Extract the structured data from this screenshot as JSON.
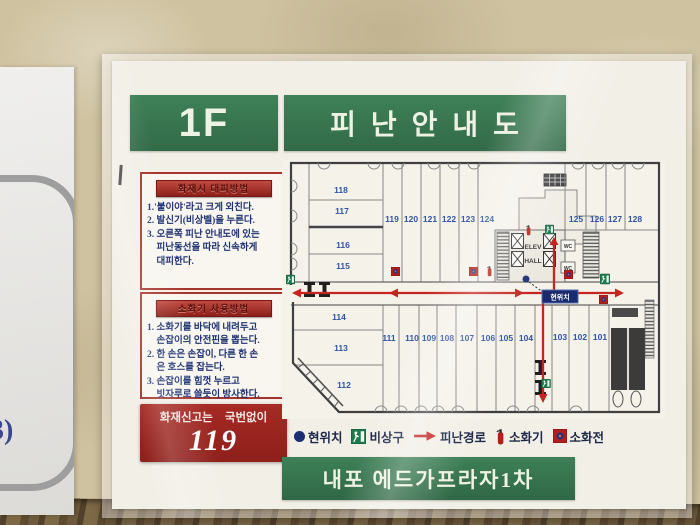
{
  "photo": {
    "side_label": "3)"
  },
  "colors": {
    "header_green": "#37784f",
    "footer_green": "#37784f",
    "alert_red": "#9c241f",
    "route_red": "#c5241f",
    "room_number_blue": "#2e54a3",
    "location_navy": "#1a2a6e",
    "exit_green": "#1e7a4c"
  },
  "sign": {
    "header": {
      "floor": "1F",
      "title": "피난안내도"
    },
    "instructions_fire": {
      "title": "화재시 대피방법",
      "body": "1.'불이야'라고 크게 외친다.\n2. 발신기(비상벨)을 누른다.\n3. 오른쪽 피난 안내도에 있는\n　피난동선을 따라 신속하게\n　대피한다."
    },
    "instructions_extinguisher": {
      "title": "소화기 사용방법",
      "body": "1. 소화기를 바닥에 내려두고\n　손잡이의 안전핀을 뽑는다.\n2. 한 손은 손잡이, 다른 한 손\n　은 호스를 잡는다.\n3. 손잡이를 힘껏 누르고\n　빗자루로 쓸듯이 방사한다."
    },
    "emergency_call": {
      "label": "화재신고는 국번없이",
      "number": "119"
    },
    "legend": {
      "items": [
        {
          "icon": "location-dot",
          "label": "현위치"
        },
        {
          "icon": "emergency-exit",
          "label": "비상구"
        },
        {
          "icon": "route-arrow",
          "label": "피난경로"
        },
        {
          "icon": "fire-extinguisher",
          "label": "소화기"
        },
        {
          "icon": "fire-hydrant",
          "label": "소화전"
        }
      ]
    },
    "footer": {
      "building": "내포 에드가프라자1차"
    },
    "map": {
      "current_location_badge": "현위치",
      "elevator_label_line1": "ELEV",
      "elevator_label_line2": "HALL",
      "wc_label": "WC",
      "rooms": {
        "101": "101",
        "102": "102",
        "103": "103",
        "104": "104",
        "105": "105",
        "106": "106",
        "107": "107",
        "108": "108",
        "109": "109",
        "110": "110",
        "111": "111",
        "112": "112",
        "113": "113",
        "114": "114",
        "115": "115",
        "116": "116",
        "117": "117",
        "118": "118",
        "119": "119",
        "120": "120",
        "121": "121",
        "122": "122",
        "123": "123",
        "124": "124",
        "125": "125",
        "126": "126",
        "127": "127",
        "128": "128"
      }
    }
  }
}
